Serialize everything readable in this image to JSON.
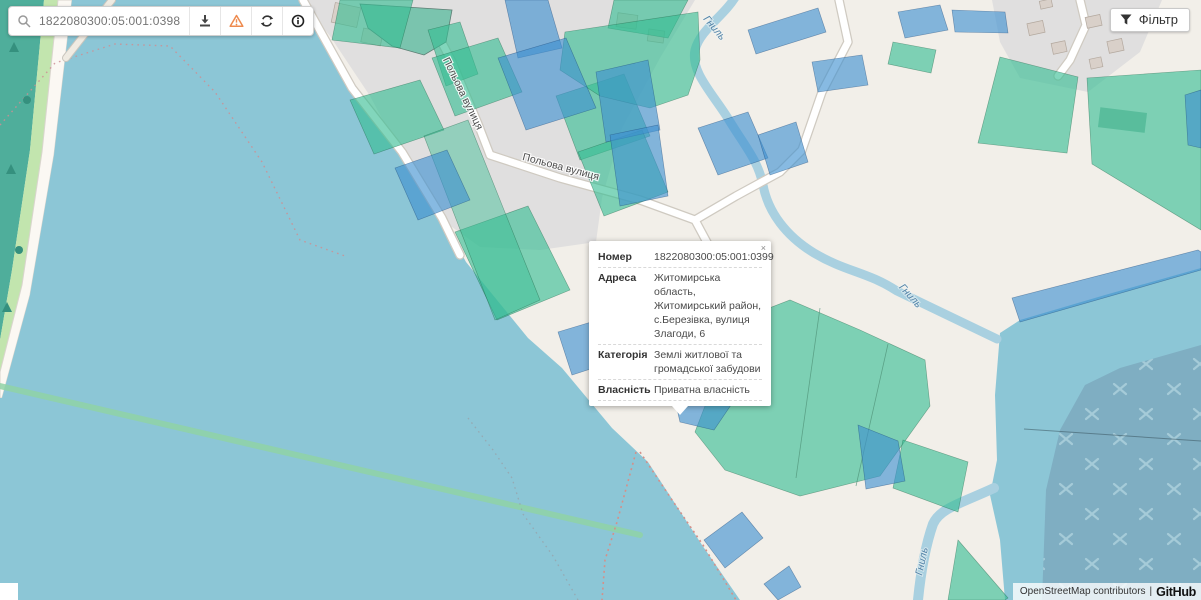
{
  "search_bar": {
    "value": "1822080300:05:001:0398"
  },
  "filter": {
    "label": "Фільтр"
  },
  "popup": {
    "close_label": "×",
    "rows": [
      {
        "label": "Номер",
        "value": "1822080300:05:001:0399"
      },
      {
        "label": "Адреса",
        "value": "Житомирська область, Житомирський район, с.Березівка, вулиця Злагоди, 6"
      },
      {
        "label": "Категорія",
        "value": "Землі житлової та громадської забудови"
      },
      {
        "label": "Власність",
        "value": "Приватна власність"
      }
    ]
  },
  "map_labels": {
    "street": "Польова вулиця",
    "river": "Гниль"
  },
  "attribution": {
    "text": "OpenStreetMap contributors",
    "separator": "|",
    "brand": "GitHub"
  },
  "icons": {
    "search": "search-icon",
    "download": "download-icon",
    "warning": "warning-triangle-icon",
    "refresh": "refresh-icon",
    "info": "info-circle-icon",
    "filter": "funnel-icon",
    "close": "close-icon"
  },
  "colors": {
    "land": "#F2EFE9",
    "residential": "#E0DFDF",
    "water": "#8CC6D6",
    "forest": "#4FAE9B",
    "parcel_teal": "#7DD0B4",
    "parcel_blue": "#82B3D9",
    "selected_parcel": "#3EC48D",
    "quarry": "#7FAEC2",
    "stream": "#A9D0E0",
    "warning_orange": "#EE8A4E"
  }
}
